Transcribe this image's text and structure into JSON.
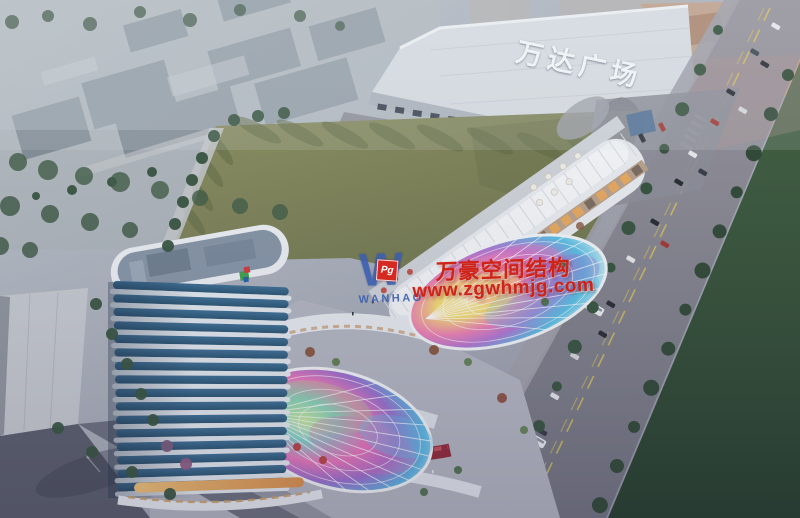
{
  "signage": {
    "mall_sign": "万达广场"
  },
  "watermark": {
    "logo_letter": "W",
    "logo_monogram": "Pg",
    "logo_name": "WANHAO",
    "company": "万豪空间结构",
    "website": "www.zgwhmjg.com",
    "text_color": "#cf2318",
    "logo_color": "#3a5fb0",
    "monogram_bg": "#d42a22"
  },
  "colors": {
    "sky_haze": "#b2bcc4",
    "field_green": "#7d8155",
    "park_green": "#2f4a33",
    "road_gray": "#8e8f99",
    "tower_band": "#e6ecf1",
    "tower_glass_dark": "#24516f",
    "tower_glass_light": "#3a6d94",
    "mall_white": "#d8dde2",
    "mall_roof_tan": "#c0a28c",
    "canopy_pink": "#ef7fb2",
    "canopy_cyan": "#55bfe4",
    "canopy_yellow": "#f6dc6e",
    "canopy_purple": "#b273d2",
    "led_red": "#8e2433",
    "storefront_warm": "#e8a85a",
    "tree_green": "#33503a"
  }
}
